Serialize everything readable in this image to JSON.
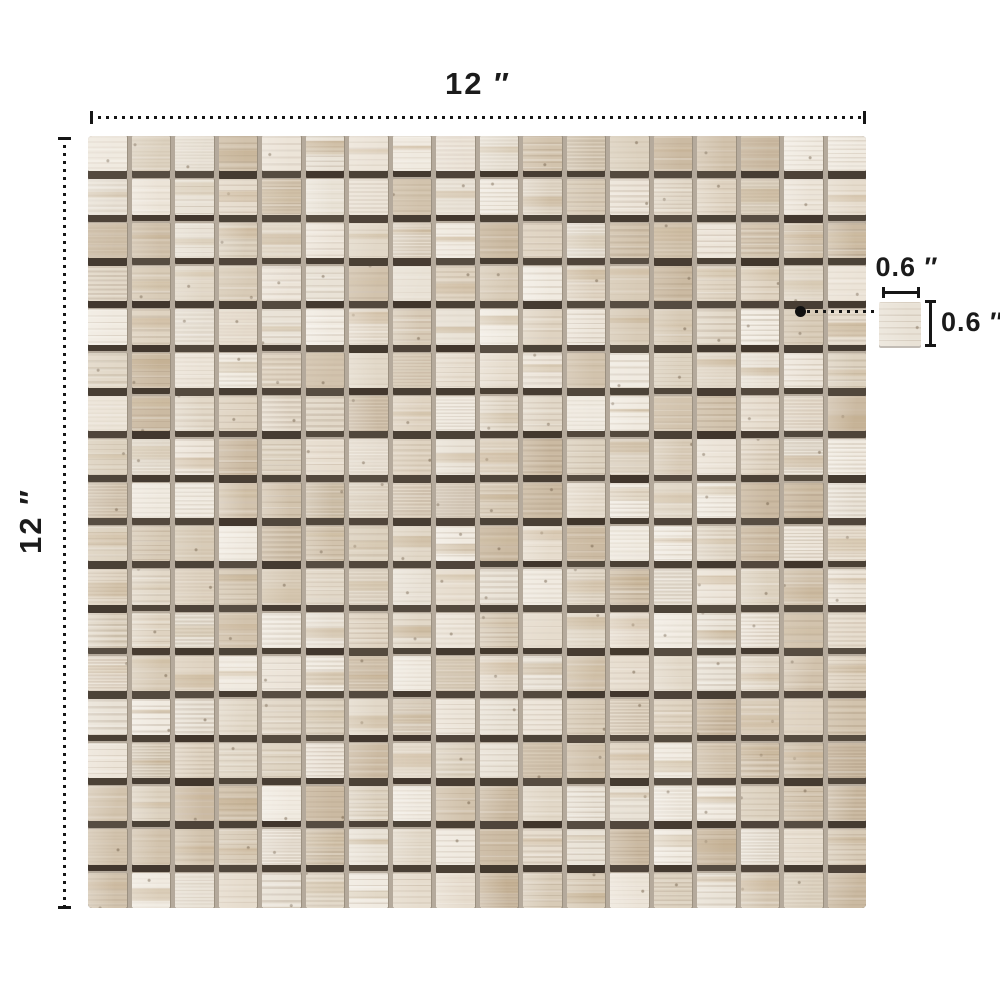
{
  "dimensions": {
    "sheet_width": "12 ″",
    "sheet_height": "12 ″",
    "chip_width": "0.6 ″",
    "chip_height": "0.6 ″"
  },
  "mosaic": {
    "rows": 18,
    "cols": 18,
    "seed": 20240613,
    "chip_seed": 77,
    "base_colors": [
      "#ece4d8",
      "#e6dccd",
      "#dfd3c1",
      "#d8cbb7",
      "#e9e2d6",
      "#e2d8c8",
      "#d2c3ad",
      "#f0eae0",
      "#ddd2c0",
      "#cbbaa2"
    ],
    "accent_colors": [
      "#c8b293",
      "#bfa886",
      "#cdbb9e"
    ],
    "streak_rgb": "139,117,92",
    "grout_color": "#b5aa9c",
    "shadow_rgb": "62,52,42",
    "line_color": "#161616",
    "background": "#ffffff"
  }
}
